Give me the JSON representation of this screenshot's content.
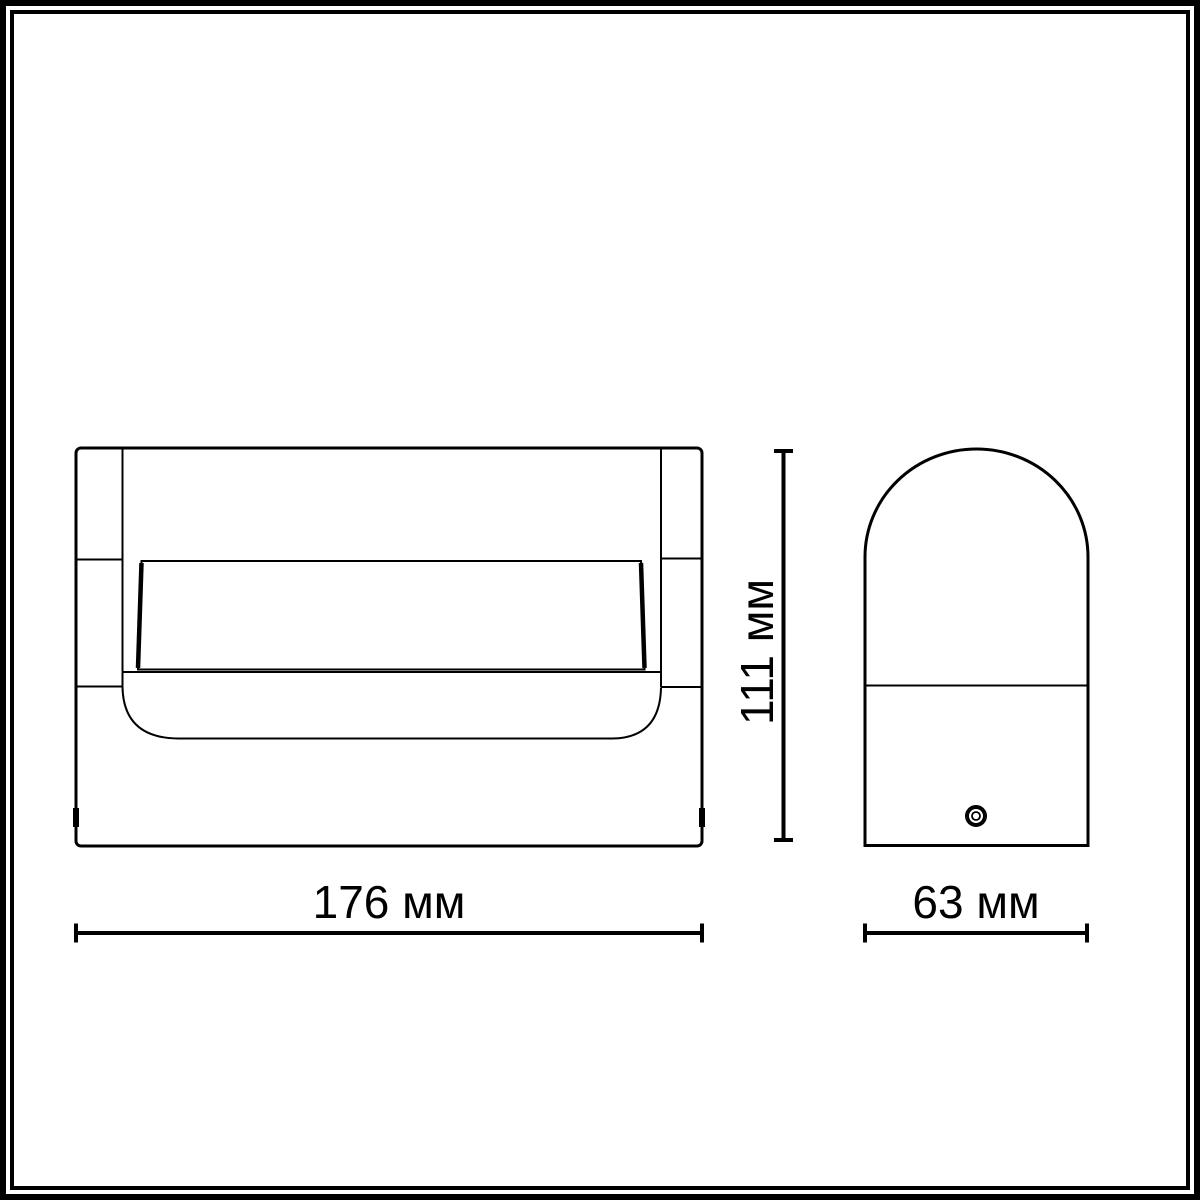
{
  "page": {
    "background_color": "#ffffff",
    "line_color": "#000000"
  },
  "drawing": {
    "type": "technical-dimension-drawing",
    "views": [
      "front-view",
      "side-view"
    ],
    "dimensions": {
      "width": {
        "label": "176 мм",
        "value_mm": 176
      },
      "height": {
        "label": "111 мм",
        "value_mm": 111
      },
      "depth": {
        "label": "63 мм",
        "value_mm": 63
      }
    }
  }
}
